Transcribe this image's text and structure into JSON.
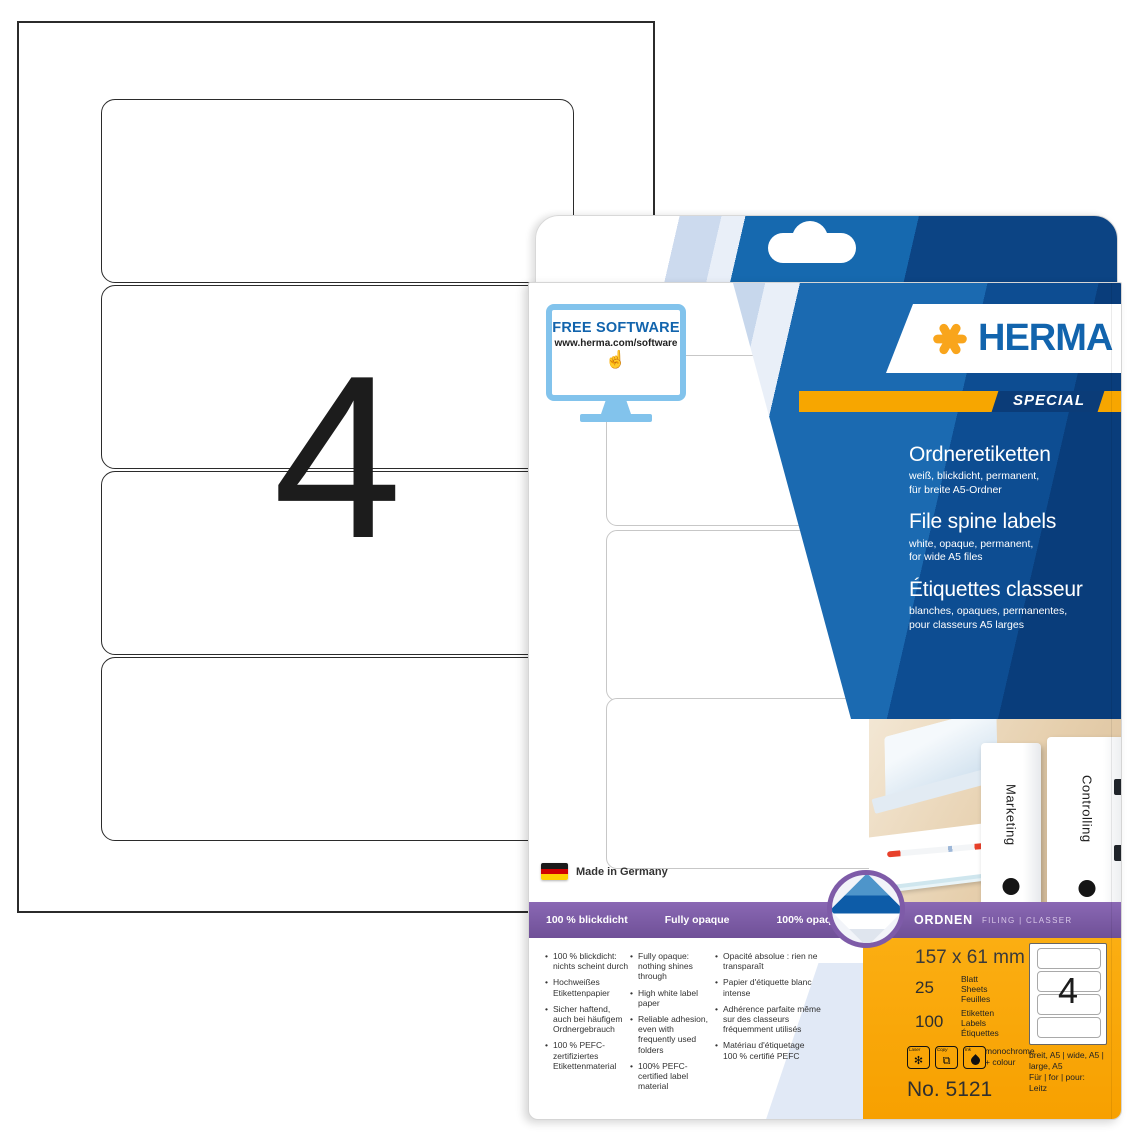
{
  "sheet": {
    "count_label": "4"
  },
  "package": {
    "free_software": {
      "title": "FREE SOFTWARE",
      "url": "www.herma.com/software"
    },
    "brand": {
      "name": "HERMA",
      "special": "SPECIAL"
    },
    "titles": {
      "de": {
        "title": "Ordneretiketten",
        "sub1": "weiß, blickdicht, permanent,",
        "sub2": "für breite A5-Ordner"
      },
      "en": {
        "title": "File spine labels",
        "sub1": "white, opaque, permanent,",
        "sub2": "for wide A5 files"
      },
      "fr": {
        "title": "Étiquettes classeur",
        "sub1": "blanches, opaques, permanentes,",
        "sub2": "pour classeurs A5 larges"
      }
    },
    "photo": {
      "folder1": "Marketing",
      "folder2": "Controlling"
    },
    "made_in": "Made in Germany",
    "opacity_bar": {
      "de": "100 % blickdicht",
      "en": "Fully opaque",
      "fr": "100% opaques"
    },
    "category_bar": {
      "title": "ORDNEN",
      "subtitle": "FILING | CLASSER"
    },
    "features": {
      "de": [
        "100 % blickdicht: nichts scheint durch",
        "Hochweißes Etiketten­papier",
        "Sicher haftend, auch bei häufigem Ordnergebrauch",
        "100 % PEFC-zertifiziertes Etikettenmaterial"
      ],
      "en": [
        "Fully opaque: nothing shines through",
        "High white label paper",
        "Reliable adhesion, even with frequently used folders",
        "100% PEFC-certified label material"
      ],
      "fr": [
        "Opacité absolue : rien ne transparaît",
        "Papier d'étiquette blanc intense",
        "Adhérence parfaite même sur des classeurs fréquemment utilisés",
        "Matériau d'étiquetage 100 % certifié PEFC"
      ]
    },
    "specs": {
      "size": "157 x 61 mm",
      "sheets_count": "25",
      "sheets_labels": [
        "Blatt",
        "Sheets",
        "Feuilles"
      ],
      "labels_count": "100",
      "labels_labels": [
        "Etiketten",
        "Labels",
        "Étiquettes"
      ],
      "printer": {
        "laser": "Laser",
        "copy": "Copy",
        "ink": "Ink",
        "mode1": "monochrome",
        "mode2": "+ colour"
      },
      "mini_sheet_count": "4",
      "format_line1": "breit, A5 | wide, A5 |",
      "format_line2": "large, A5",
      "for_line1": "Für | for | pour:",
      "for_line2": "Leitz",
      "article_no": "No. 5121"
    },
    "colors": {
      "herma_blue": "#1264ad",
      "herma_orange": "#f7a600",
      "special_navy": "#0b3c78",
      "purple": "#7e5ba8",
      "panel_orange": "#f9a700"
    }
  }
}
